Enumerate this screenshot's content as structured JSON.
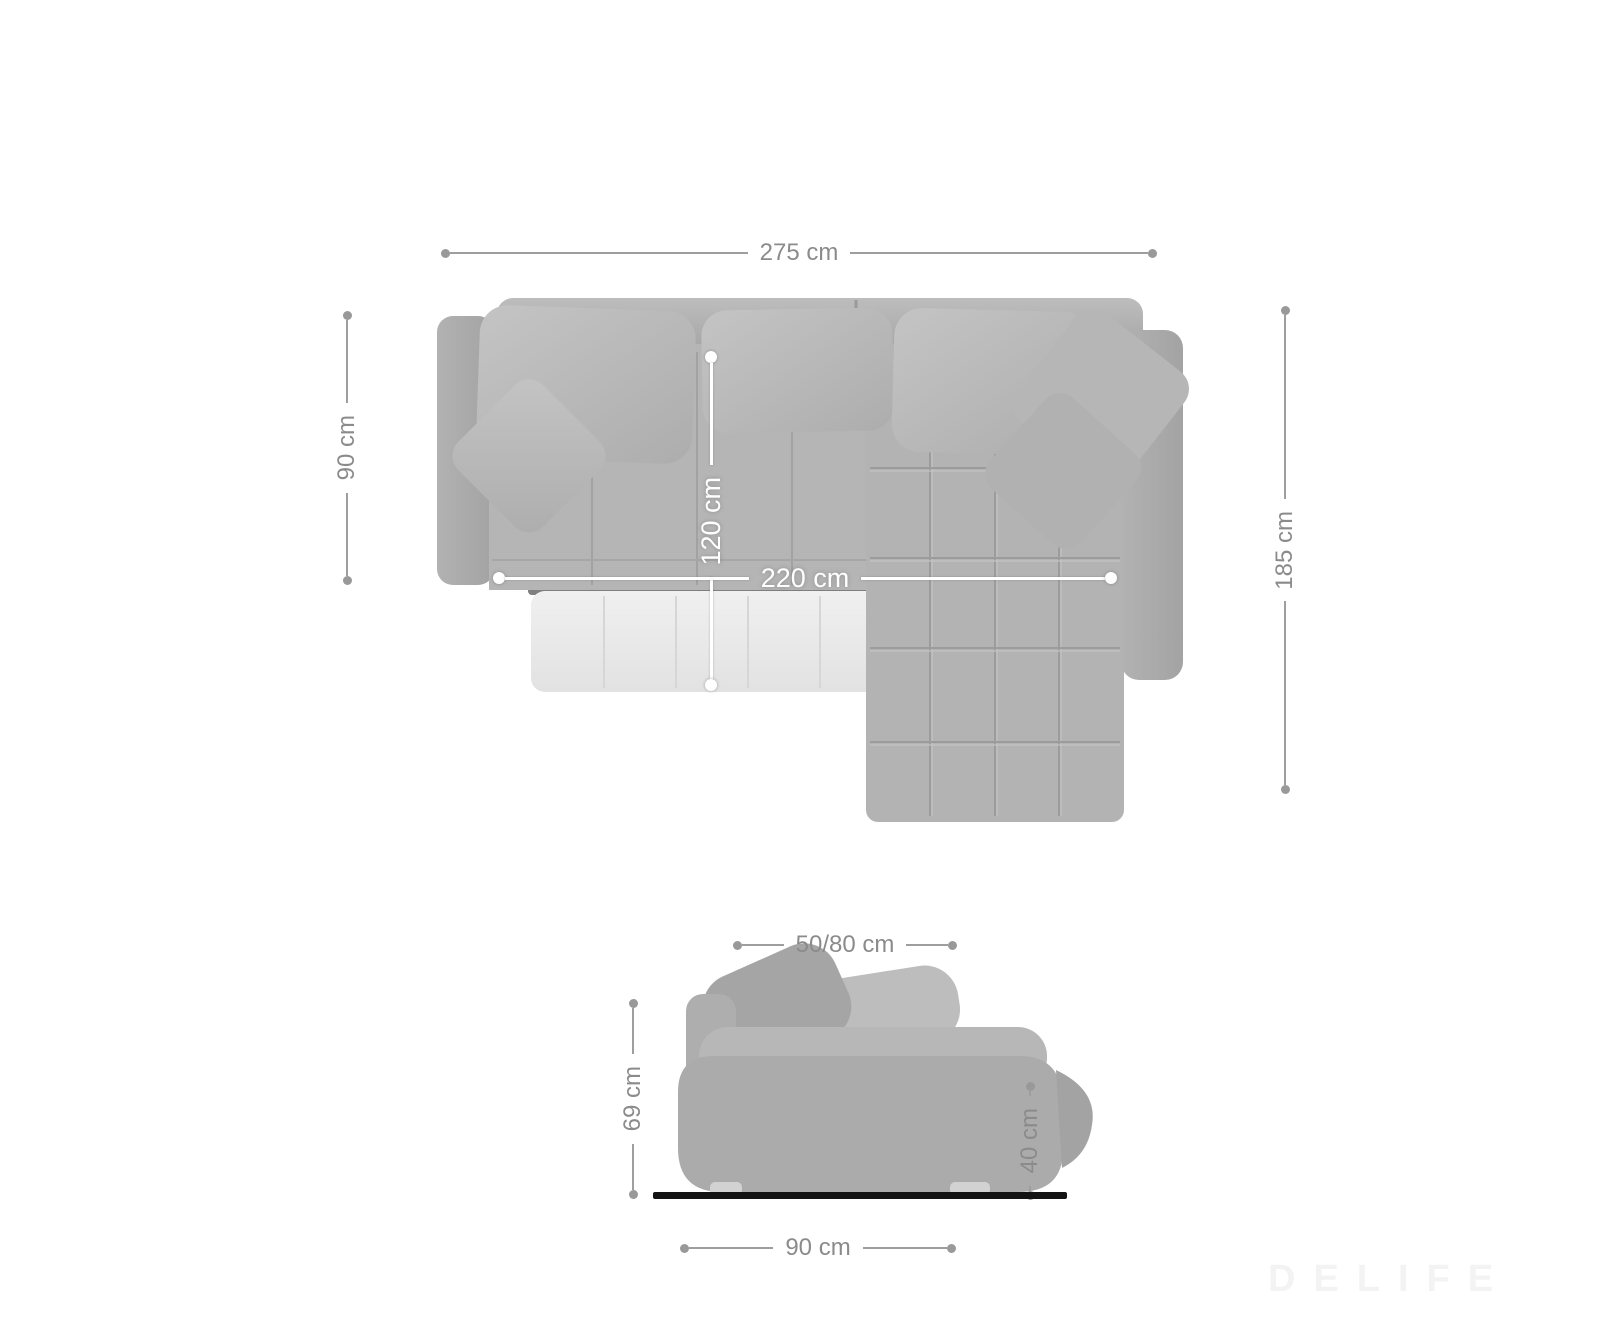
{
  "page": {
    "background": "#ffffff",
    "watermark_text": "DELIFE"
  },
  "colors": {
    "dimension_line": "#9e9e9e",
    "dimension_text": "#8b8b8b",
    "inner_dimension": "#ffffff",
    "floor_line": "#131313",
    "sofa_gray": "#b3b3b3",
    "pullout_light": "#eaeaea"
  },
  "top_view": {
    "total_width": {
      "label": "275 cm"
    },
    "seat_depth_left": {
      "label": "90 cm"
    },
    "total_depth_right": {
      "label": "185 cm"
    },
    "bed_width": {
      "label": "120 cm"
    },
    "bed_length": {
      "label": "220 cm"
    }
  },
  "side_view": {
    "backrest_depth": {
      "label": "50/80 cm"
    },
    "total_height": {
      "label": "69 cm"
    },
    "seat_height": {
      "label": "40 cm"
    },
    "side_depth": {
      "label": "90 cm"
    }
  }
}
